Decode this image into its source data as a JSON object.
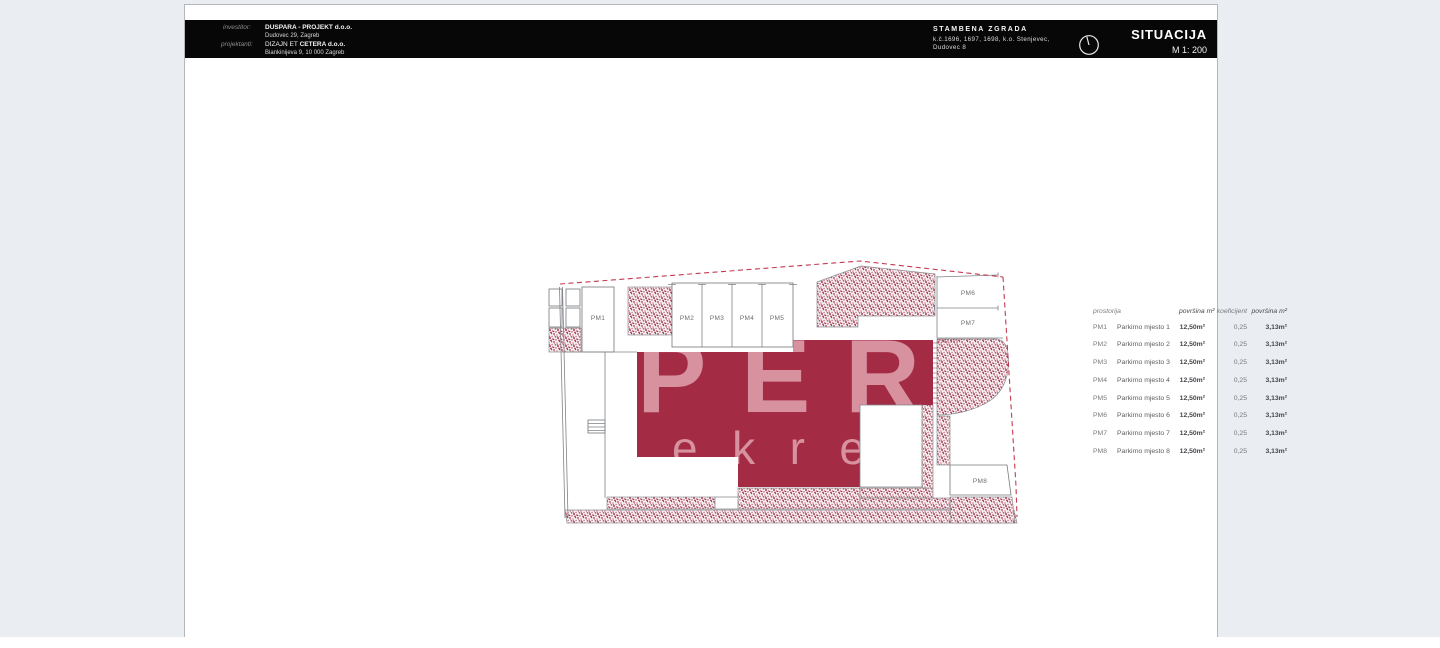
{
  "title_block": {
    "investor_label": "investitor:",
    "investor_name": "DUSPARA - PROJEKT d.o.o.",
    "investor_address": "Dudovec 29, Zagreb",
    "designer_label": "projektanti:",
    "designer_name_prefix": "DIZAJN ET ",
    "designer_name_bold": "CETERA d.o.o.",
    "designer_address": "Biankinijeva 9, 10 000 Zagreb",
    "project_title": "STAMBENA ZGRADA",
    "project_parcels": "k.č.1696, 1697, 1698, k.o. Stenjevec,",
    "project_address": "Dudovec 8",
    "north_icon": "circle-pointer-icon",
    "drawing_title": "SITUACIJA",
    "scale": "M 1: 200"
  },
  "plan": {
    "labels": {
      "pm1": "PM1",
      "pm2": "PM2",
      "pm3": "PM3",
      "pm4": "PM4",
      "pm5": "PM5",
      "pm6": "PM6",
      "pm7": "PM7",
      "pm8": "PM8"
    },
    "watermark_line1": "PER",
    "watermark_line2": "ekre",
    "colors": {
      "building": "#a32b44",
      "watermark": "#d7919f",
      "hatch_dot": "#a63b54",
      "boundary_dash": "#c43a50",
      "line": "#7f8287"
    }
  },
  "table": {
    "headers": [
      "prostorija",
      "površina m²",
      "koeficijent",
      "površina m²"
    ],
    "rows": [
      {
        "id": "PM1",
        "name": "Parkirno mjesto 1",
        "area": "12,50m²",
        "coef": "0,25",
        "area2": "3,13m²"
      },
      {
        "id": "PM2",
        "name": "Parkirno mjesto 2",
        "area": "12,50m²",
        "coef": "0,25",
        "area2": "3,13m²"
      },
      {
        "id": "PM3",
        "name": "Parkirno mjesto 3",
        "area": "12,50m²",
        "coef": "0,25",
        "area2": "3,13m²"
      },
      {
        "id": "PM4",
        "name": "Parkirno mjesto 4",
        "area": "12,50m²",
        "coef": "0,25",
        "area2": "3,13m²"
      },
      {
        "id": "PM5",
        "name": "Parkirno mjesto 5",
        "area": "12,50m²",
        "coef": "0,25",
        "area2": "3,13m²"
      },
      {
        "id": "PM6",
        "name": "Parkirno mjesto 6",
        "area": "12,50m²",
        "coef": "0,25",
        "area2": "3,13m²"
      },
      {
        "id": "PM7",
        "name": "Parkirno mjesto 7",
        "area": "12,50m²",
        "coef": "0,25",
        "area2": "3,13m²"
      },
      {
        "id": "PM8",
        "name": "Parkirno mjesto 8",
        "area": "12,50m²",
        "coef": "0,25",
        "area2": "3,13m²"
      }
    ]
  }
}
